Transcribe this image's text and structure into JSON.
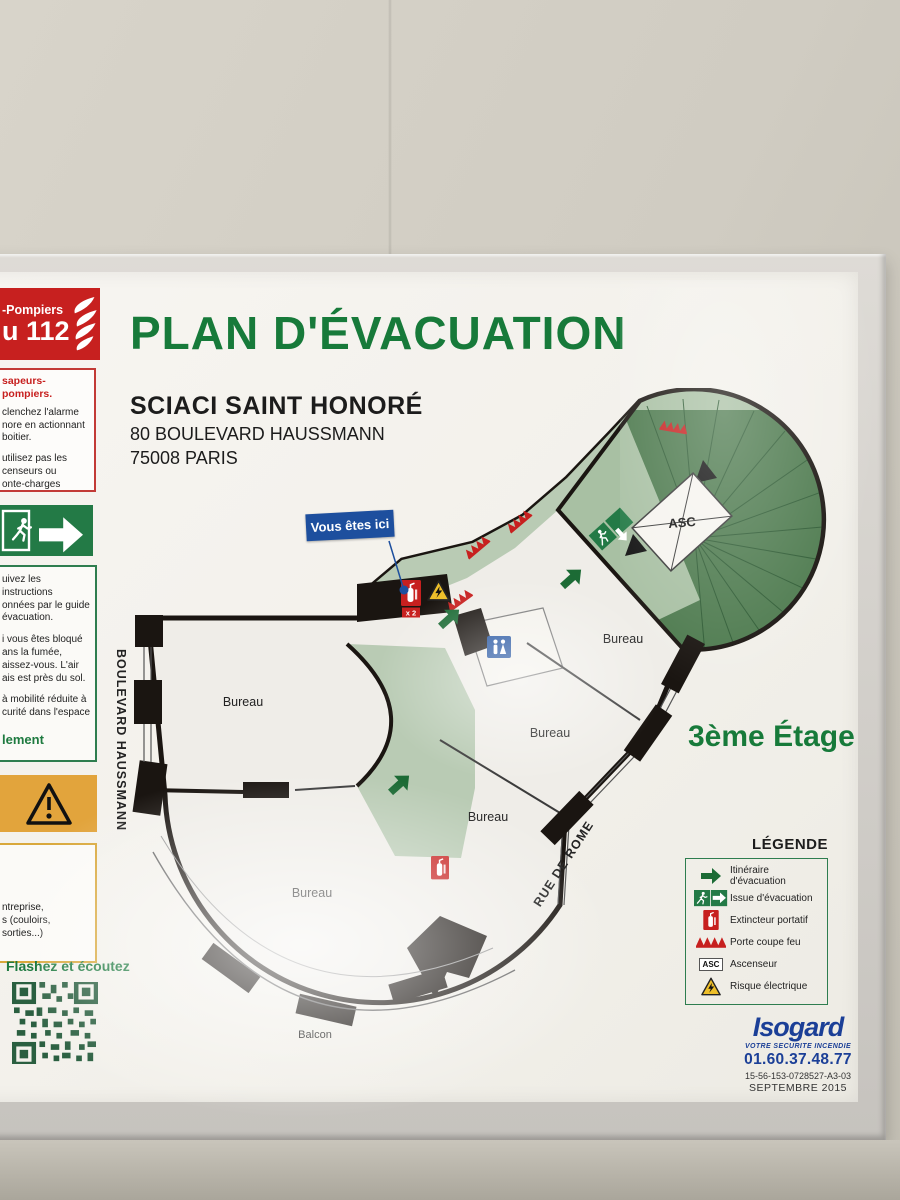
{
  "poster": {
    "title": "PLAN D'ÉVACUATION",
    "site_name": "SCIACI SAINT HONORÉ",
    "site_address_line1": "80 BOULEVARD HAUSSMANN",
    "site_address_line2": "75008 PARIS",
    "floor_label": "3ème Étage",
    "you_are_here_label": "Vous êtes ici"
  },
  "sidebar": {
    "emergency": {
      "line1": "-Pompiers",
      "line2": "u 112"
    },
    "alarm": {
      "header": "sapeurs-pompiers.",
      "body1": "clenchez l'alarme\nnore en actionnant\nboitier.",
      "body2": "utilisez pas les\ncenseurs ou\nonte-charges"
    },
    "instructions": {
      "para1": "uivez les instructions\nonnées par le guide\névacuation.",
      "para2": "i vous êtes bloqué\nans la fumée,\naissez-vous. L'air\nais est près du sol.",
      "para3": "à mobilité réduite à\ncurité dans l'espace",
      "highlight": "lement"
    },
    "notice": {
      "body": "ntreprise,\ns (couloirs, sorties...)"
    },
    "qr_caption": "Flashez et écoutez"
  },
  "plan": {
    "room_labels": {
      "bureau1": "Bureau",
      "bureau2": "Bureau",
      "bureau3": "Bureau",
      "bureau4": "Bureau",
      "bureau5": "Bureau",
      "balcony": "Balcon",
      "elevator": "ASC"
    },
    "streets": {
      "boulevard": "BOULEVARD HAUSSMANN",
      "rue": "RUE DE ROME"
    },
    "extinguisher_count": "x 2"
  },
  "legend": {
    "title": "LÉGENDE",
    "elevator_abbr": "ASC",
    "items": [
      {
        "icon": "evacuation-route-arrow-icon",
        "label": "Itinéraire d'évacuation"
      },
      {
        "icon": "exit-sign-icon",
        "label": "Issue d'évacuation"
      },
      {
        "icon": "fire-extinguisher-icon",
        "label": "Extincteur portatif"
      },
      {
        "icon": "fire-door-icon",
        "label": "Porte coupe feu"
      },
      {
        "icon": "elevator-icon",
        "label": "Ascenseur"
      },
      {
        "icon": "electrical-hazard-icon",
        "label": "Risque électrique"
      }
    ]
  },
  "footer": {
    "brand": "Isogard",
    "tagline": "VOTRE SECURITE INCENDIE",
    "phone": "01.60.37.48.77",
    "reference": "15-56-153-0728527-A3-03",
    "date": "SEPTEMBRE 2015"
  },
  "colors": {
    "title_green": "#177a3a",
    "safety_green": "#237a46",
    "corridor_green": "#b9cbb4",
    "stairwell_green": "#4d7a4e",
    "alert_red": "#c7201f",
    "info_blue": "#1d4f9e",
    "brand_blue": "#1b3f97",
    "warning_yellow": "#e2a43c"
  }
}
